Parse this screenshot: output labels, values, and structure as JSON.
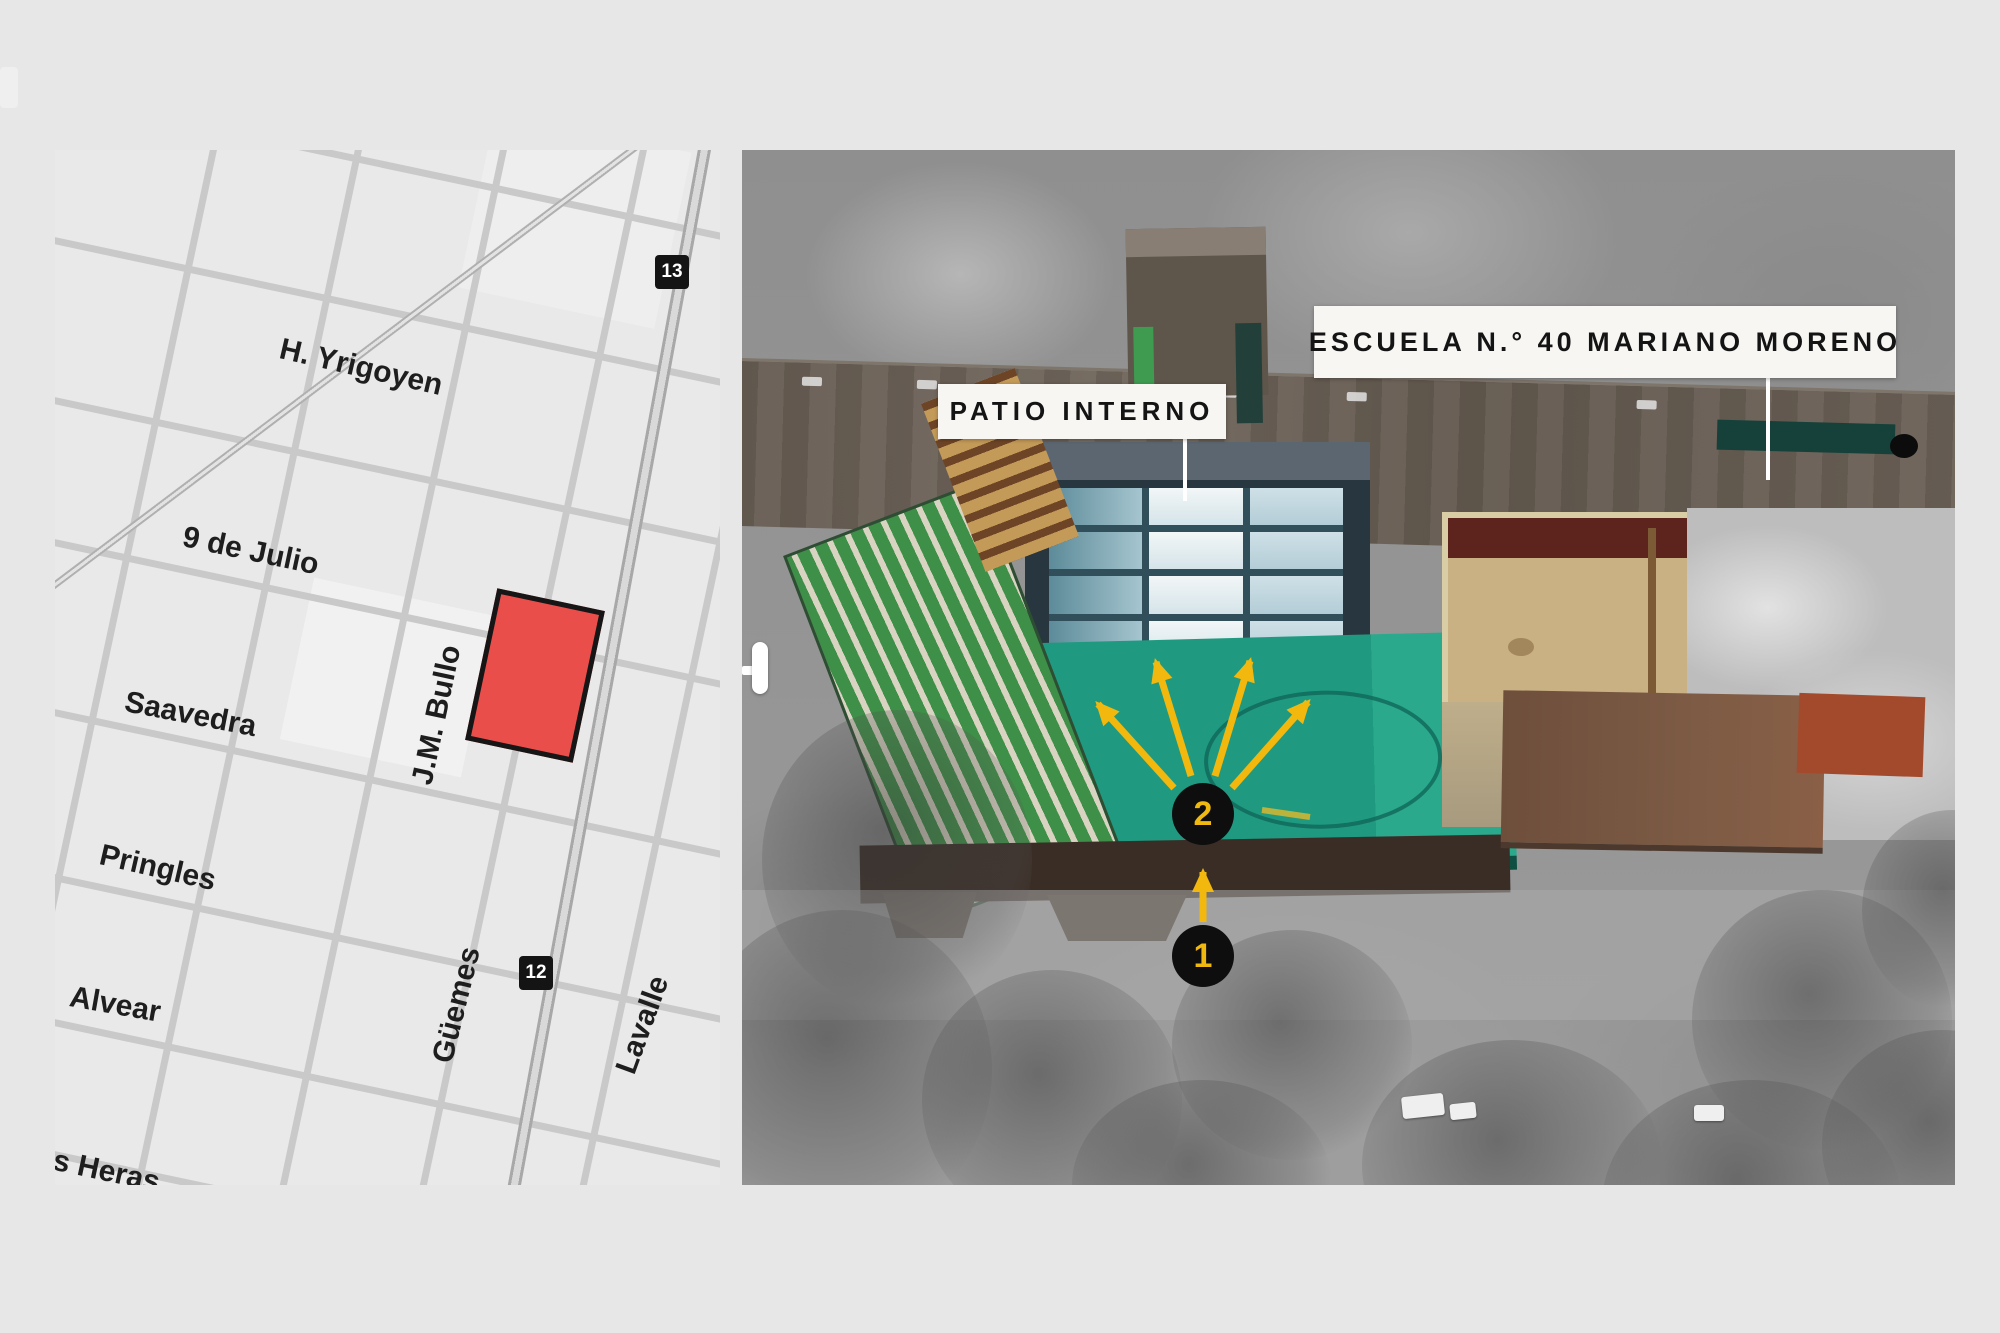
{
  "page": {
    "background_color": "#e7e7e7"
  },
  "street_map": {
    "streets": [
      {
        "name": "H. Yrigoyen"
      },
      {
        "name": "9 de Julio"
      },
      {
        "name": "Saavedra"
      },
      {
        "name": "Pringles"
      },
      {
        "name": "Alvear"
      },
      {
        "name": "as Heras"
      },
      {
        "name": "J.M. Bullo"
      },
      {
        "name": "Güemes"
      },
      {
        "name": "Lavalle"
      }
    ],
    "route_badges": [
      {
        "number": "13"
      },
      {
        "number": "12"
      }
    ],
    "highlight": {
      "color": "#ea4e4b",
      "border_color": "#161616"
    }
  },
  "aerial_view": {
    "callouts": [
      {
        "text": "PATIO INTERNO"
      },
      {
        "text": "ESCUELA N.° 40 MARIANO MORENO"
      }
    ],
    "markers": [
      {
        "number": "2"
      },
      {
        "number": "1"
      }
    ],
    "marker_style": {
      "background": "#0e0e0e",
      "number_color": "#f0b90f"
    },
    "arrow_color": "#f2b80e",
    "icons": {
      "slider_handle": "comparison-slider-handle"
    }
  }
}
